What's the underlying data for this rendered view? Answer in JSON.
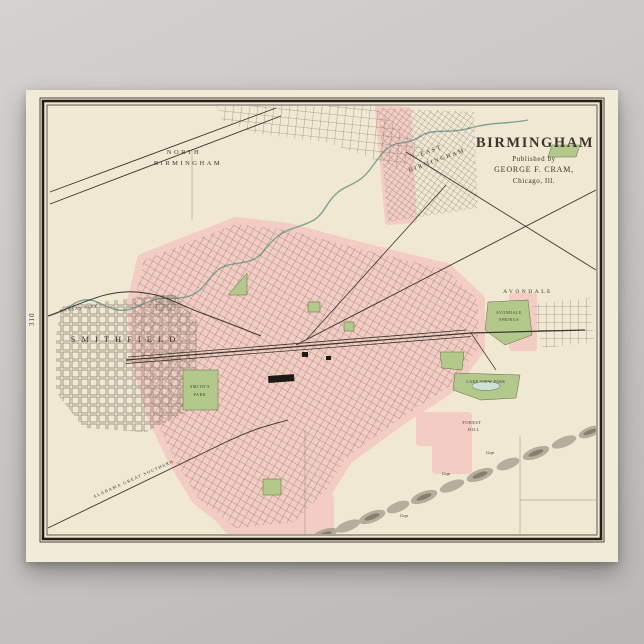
{
  "colors": {
    "page_bg": "#c9c7c4",
    "paper": "#f2ebd7",
    "map_field": "#f0e8d2",
    "urban_pink": "#f3ccc3",
    "park_green": "#b3c98b",
    "water_teal": "#78a496",
    "line_ink": "#3a352c",
    "frame_ink": "#221e19"
  },
  "title_block": {
    "title": "BIRMINGHAM",
    "published_by": "Published by",
    "publisher": "GEORGE F. CRAM,",
    "publisher_city": "Chicago, Ill."
  },
  "page_number": "310",
  "districts": {
    "north_birmingham": {
      "line1": "NORTH",
      "line2": "BIRMINGHAM"
    },
    "east_birmingham": {
      "line1": "EAST",
      "line2": "BIRMINGHAM"
    },
    "smithfield": {
      "label": "SMITHFIELD"
    },
    "avondale": {
      "label": "AVONDALE"
    }
  },
  "parks": {
    "smiths_park": {
      "line1": "SMITH'S",
      "line2": "PARK"
    },
    "lake_view_park": {
      "label": "LAKE VIEW PARK"
    },
    "avondale_springs": {
      "line1": "AVONDALE",
      "line2": "SPRINGS"
    },
    "forest_hill": {
      "line1": "FOREST",
      "line2": "HILL"
    }
  },
  "railroads": {
    "kansas_city": "KANSAS CITY",
    "alabama_great_southern": "ALABAMA GREAT SOUTHERN"
  },
  "ridge": {
    "gap_labels": [
      "Gap",
      "Gap",
      "Gap"
    ]
  }
}
